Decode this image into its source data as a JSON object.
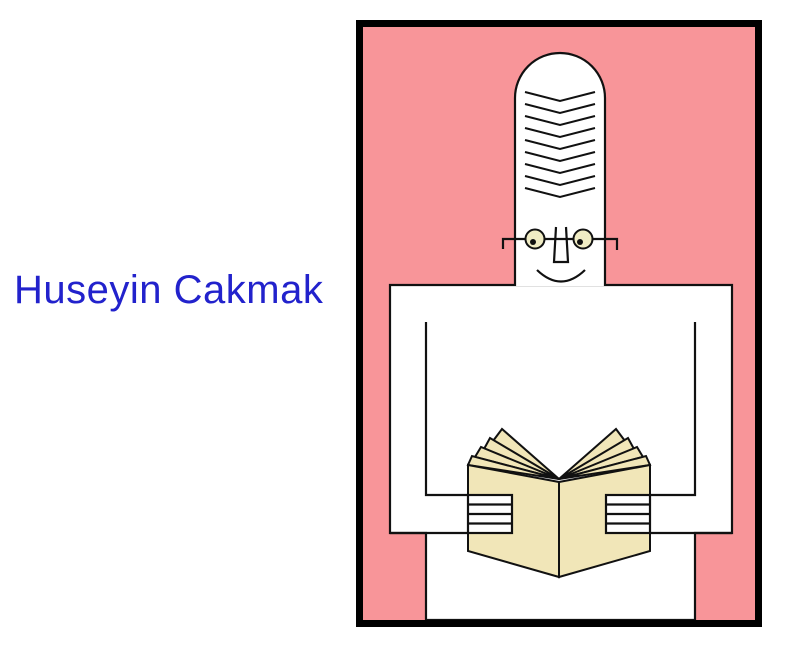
{
  "theme": {
    "page_bg": "#ffffff",
    "ink": "#111111",
    "frame_black": "#000000",
    "pink": "#F89599",
    "figure_white": "#ffffff",
    "book_cream": "#F1E6B8",
    "eye_cream": "#F0ECC4",
    "name_blue": "#2222CC"
  },
  "caption": {
    "name_label": "Huseyin Cakmak"
  }
}
